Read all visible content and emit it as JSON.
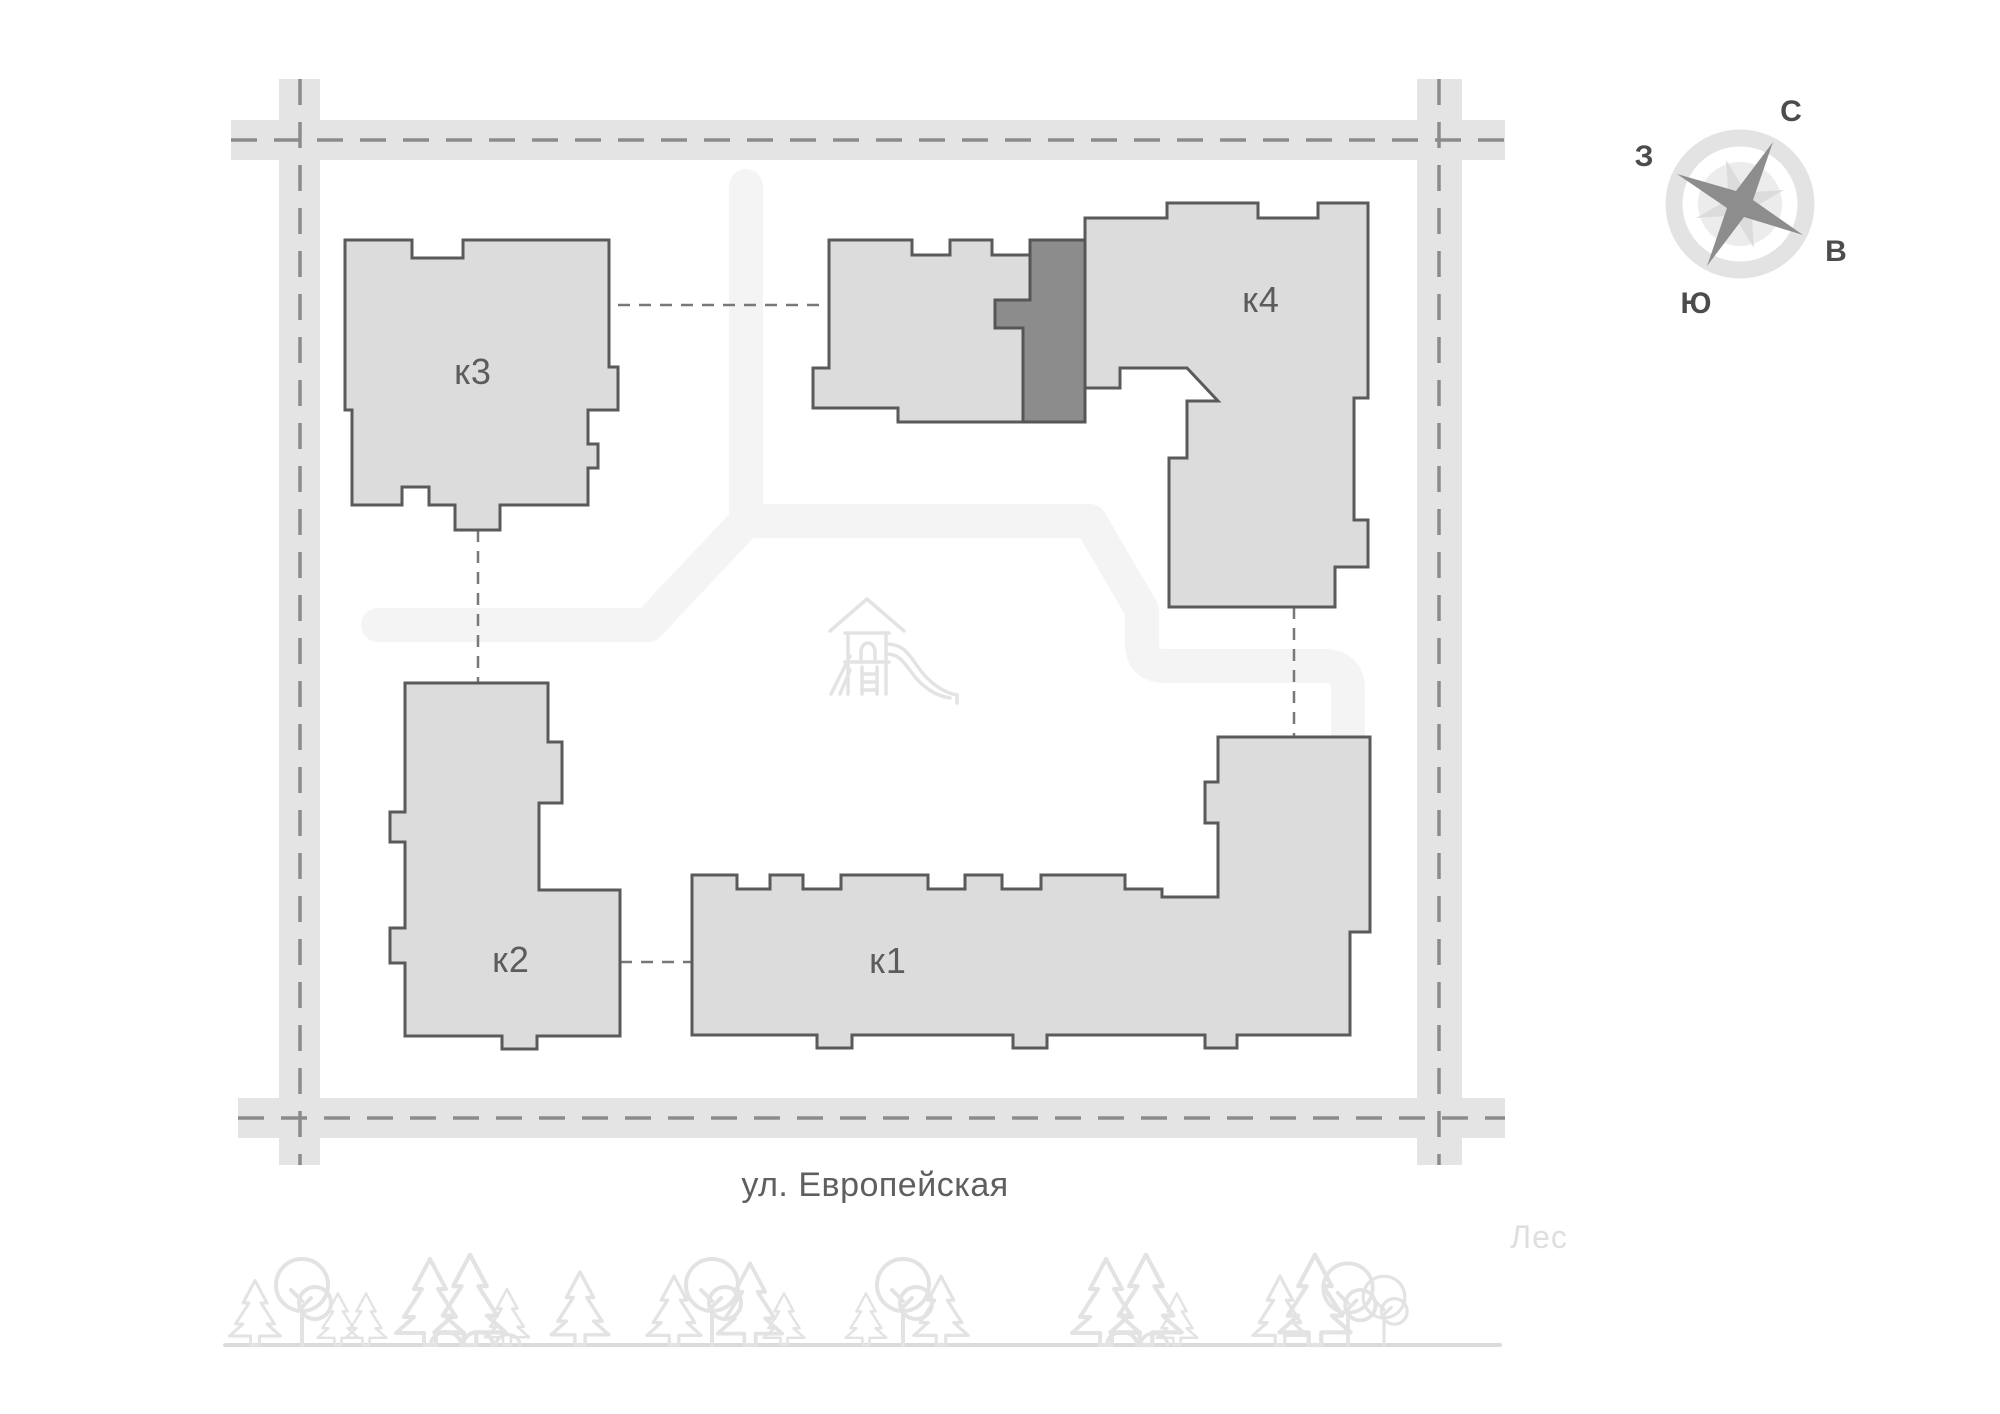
{
  "buildings": {
    "k1": {
      "label": "к1"
    },
    "k2": {
      "label": "к2"
    },
    "k3": {
      "label": "к3"
    },
    "k4": {
      "label": "к4"
    }
  },
  "highlighted_section": {
    "building": "к4",
    "color": "#8c8c8c"
  },
  "street": {
    "label": "ул. Европейская"
  },
  "forest": {
    "label": "Лес"
  },
  "compass": {
    "north": "С",
    "east": "В",
    "south": "Ю",
    "west": "З"
  },
  "icons": [
    "compass-rose-icon",
    "playground-slide-icon",
    "fir-tree-icon",
    "round-tree-icon",
    "bush-icon"
  ],
  "colors": {
    "building_fill": "#dcdcdc",
    "building_outline": "#5a5a5a",
    "highlighted_fill": "#8c8c8c",
    "road_fill": "#e4e4e4",
    "road_dash": "#8b8b8b",
    "walk_path": "#f4f4f4",
    "greenery_outline": "#e3e3e3",
    "label_text": "#5c5c5c",
    "forest_text": "#dedede"
  }
}
